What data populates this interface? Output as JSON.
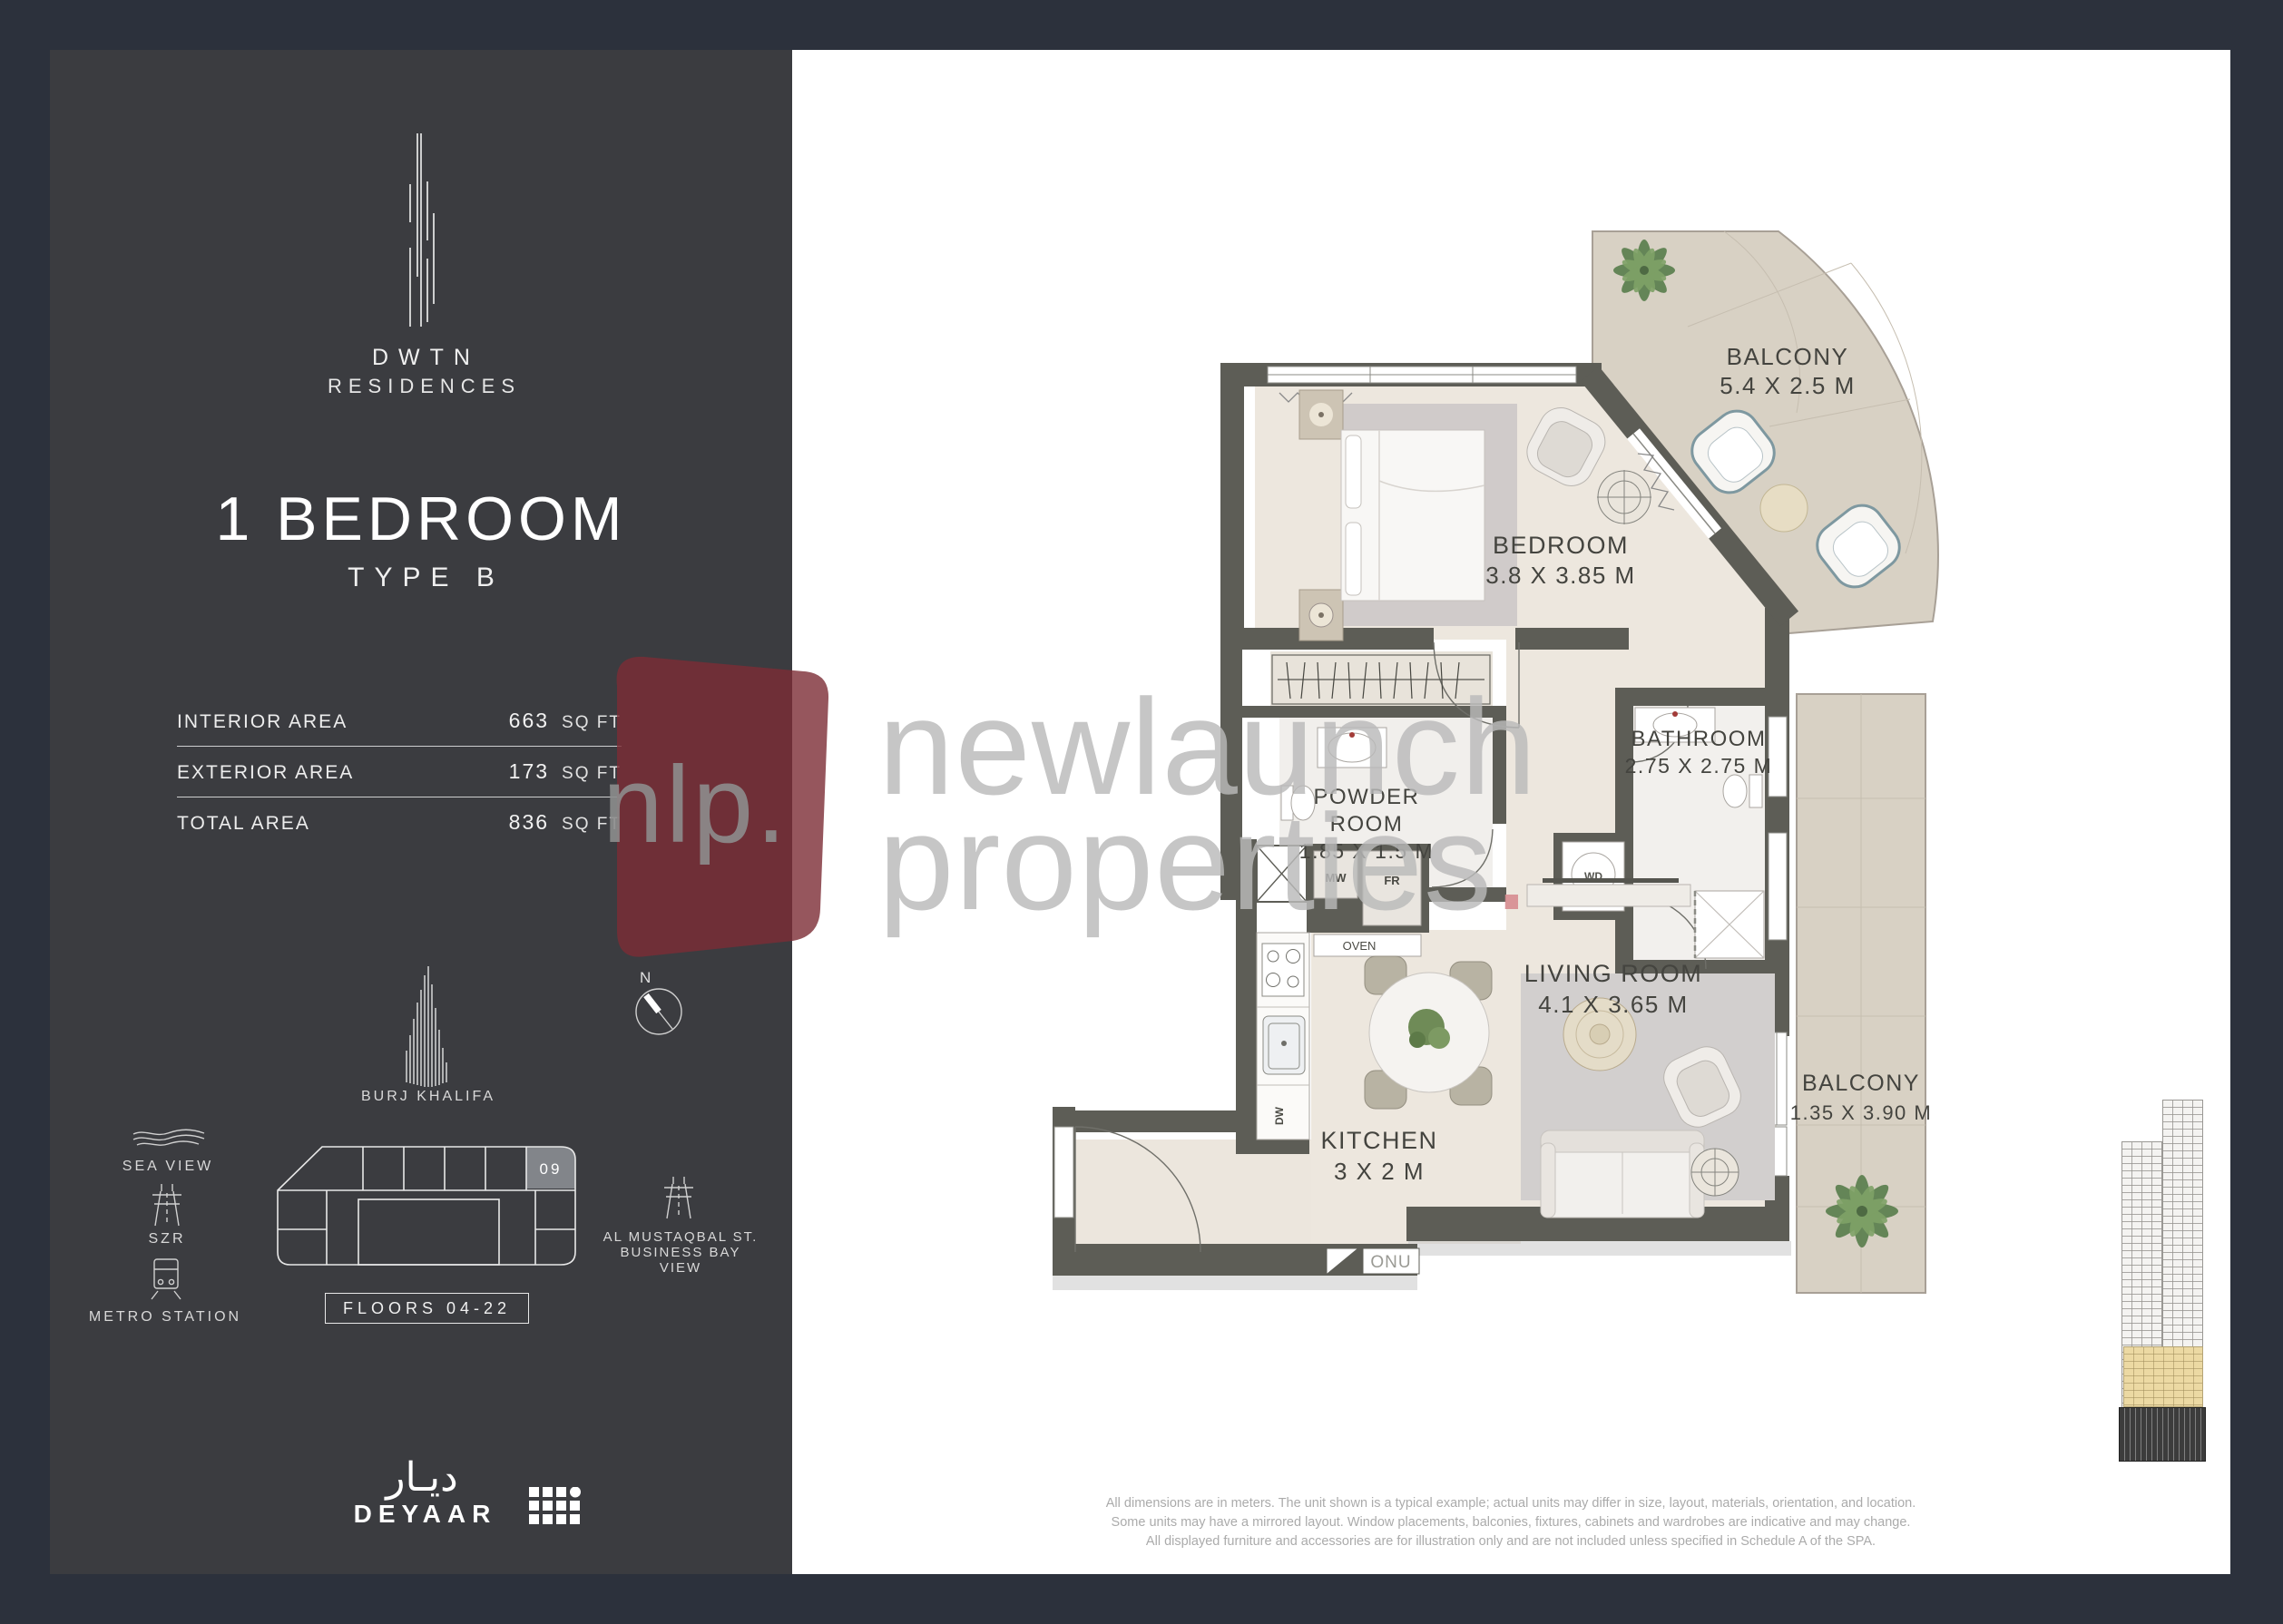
{
  "panel": {
    "brand": {
      "line1": "DWTN",
      "line2": "RESIDENCES"
    },
    "unit_title": "1 BEDROOM",
    "unit_subtitle": "TYPE B",
    "areas": [
      {
        "label": "INTERIOR AREA",
        "value": "663",
        "unit": "SQ FT"
      },
      {
        "label": "EXTERIOR AREA",
        "value": "173",
        "unit": "SQ FT"
      },
      {
        "label": "TOTAL AREA",
        "value": "836",
        "unit": "SQ FT"
      }
    ],
    "landmark_label": "BURJ KHALIFA",
    "compass_n": "N",
    "sea_view_label": "SEA VIEW",
    "szr_label": "SZR",
    "metro_label": "METRO STATION",
    "unit_badge": "09",
    "floors_label": "FLOORS 04-22",
    "road_view": {
      "line1": "AL MUSTAQBAL ST.",
      "line2": "BUSINESS BAY",
      "line3": "VIEW"
    },
    "developer": {
      "arabic": "ديـار",
      "name": "DEYAAR"
    }
  },
  "plan": {
    "rooms": [
      {
        "name": "BALCONY",
        "dims": "5.4 X 2.5 M"
      },
      {
        "name": "BEDROOM",
        "dims": "3.8 X 3.85 M"
      },
      {
        "name": "BATHROOM",
        "dims": "2.75 X 2.75 M"
      },
      {
        "name_line1": "POWDER",
        "name_line2": "ROOM",
        "dims": "1.85 X 1.5 M"
      },
      {
        "name": "LIVING ROOM",
        "dims": "4.1 X 3.65 M"
      },
      {
        "name": "KITCHEN",
        "dims": "3 X 2 M"
      },
      {
        "name": "BALCONY",
        "dims": "1.35 X 3.90 M"
      }
    ],
    "appliances": {
      "mw": "MW",
      "fr": "FR",
      "oven": "OVEN",
      "dw": "DW",
      "wd": "WD",
      "onu": "ONU"
    }
  },
  "watermark": {
    "logo": "nlp.",
    "line1": "newlaunch",
    "line2": "properties",
    "dot": "."
  },
  "disclaimer": {
    "line1": "All dimensions are in meters. The unit shown is a typical example; actual units may differ in size, layout, materials, orientation, and location.",
    "line2": "Some units may have a mirrored layout. Window placements, balconies, fixtures, cabinets and wardrobes are indicative and may change.",
    "line3": "All displayed furniture and accessories are for illustration only and are not included unless specified in Schedule A of the SPA."
  },
  "colors": {
    "panel": "#3b3c40",
    "outer": "#2c313c",
    "wall": "#5d5d56",
    "floor": "#ede7de",
    "tile": "#d8d1c4",
    "marble": "#f2f0ed",
    "accent_red": "#7c2d35",
    "highlight_unit": "#82858a"
  }
}
